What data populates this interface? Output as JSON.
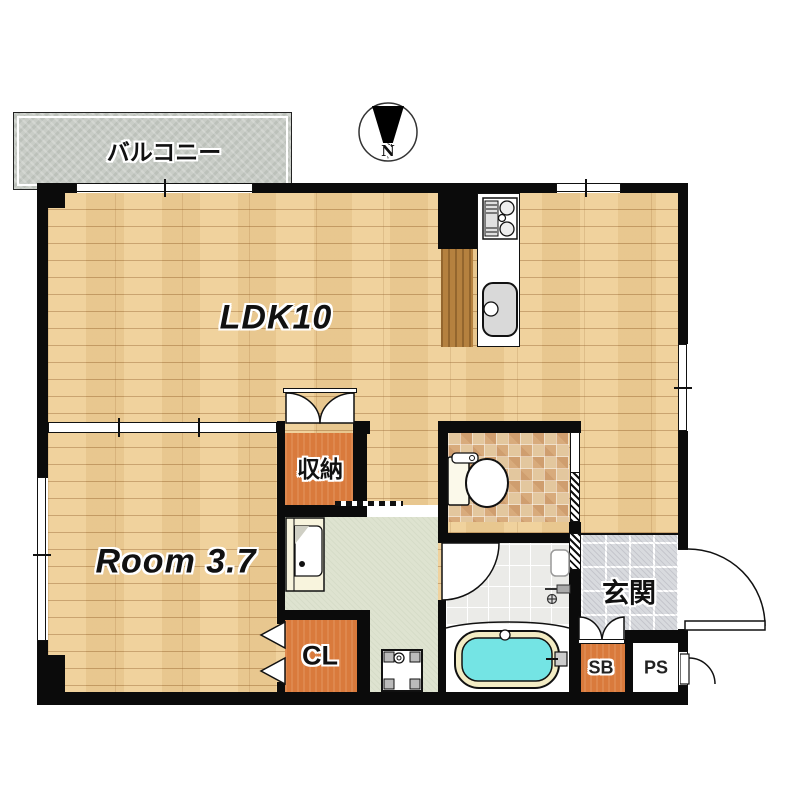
{
  "labels": {
    "balcony": "バルコニー",
    "ldk": "LDK10",
    "room": "Room 3.7",
    "storage": "収納",
    "closet": "CL",
    "entrance": "玄関",
    "shoebox": "SB",
    "pipe_space": "PS",
    "compass_north": "N"
  },
  "rooms": [
    {
      "name": "balcony",
      "label": "バルコニー",
      "floor": "concrete"
    },
    {
      "name": "living-dining-kitchen",
      "label": "LDK10",
      "floor": "light-wood"
    },
    {
      "name": "bedroom",
      "label": "Room 3.7",
      "floor": "light-wood"
    },
    {
      "name": "storage",
      "label": "収納",
      "floor": "orange-wood"
    },
    {
      "name": "closet",
      "label": "CL",
      "floor": "orange-wood"
    },
    {
      "name": "washroom",
      "label": "",
      "floor": "sage-vinyl"
    },
    {
      "name": "toilet-room",
      "label": "",
      "floor": "beige-mosaic-tile"
    },
    {
      "name": "bathroom",
      "label": "",
      "floor": "white-tile"
    },
    {
      "name": "entrance-hall",
      "label": "玄関",
      "floor": "gray-tile"
    },
    {
      "name": "shoe-box",
      "label": "SB",
      "floor": "orange-wood"
    },
    {
      "name": "pipe-space",
      "label": "PS",
      "floor": "none"
    }
  ],
  "fixtures": [
    "gas-stove",
    "kitchen-sink",
    "toilet",
    "vanity-basin",
    "washing-machine-pan",
    "bathtub",
    "shower-mixer"
  ],
  "compass": {
    "direction": "N",
    "points": "down"
  },
  "colors": {
    "wall": "#0b0b0b",
    "wood_floor": "#efcf97",
    "dark_wood": "#b5813f",
    "orange_floor": "#d97a3c",
    "balcony": "#c9cdc7",
    "entrance_tile": "#d8dade",
    "toilet_tile": "#e3c79e",
    "bath_tile": "#ebebe8",
    "washroom_floor": "#dee3d0",
    "tub_water": "#74e4e4",
    "tub_rim": "#f3ecc4"
  }
}
